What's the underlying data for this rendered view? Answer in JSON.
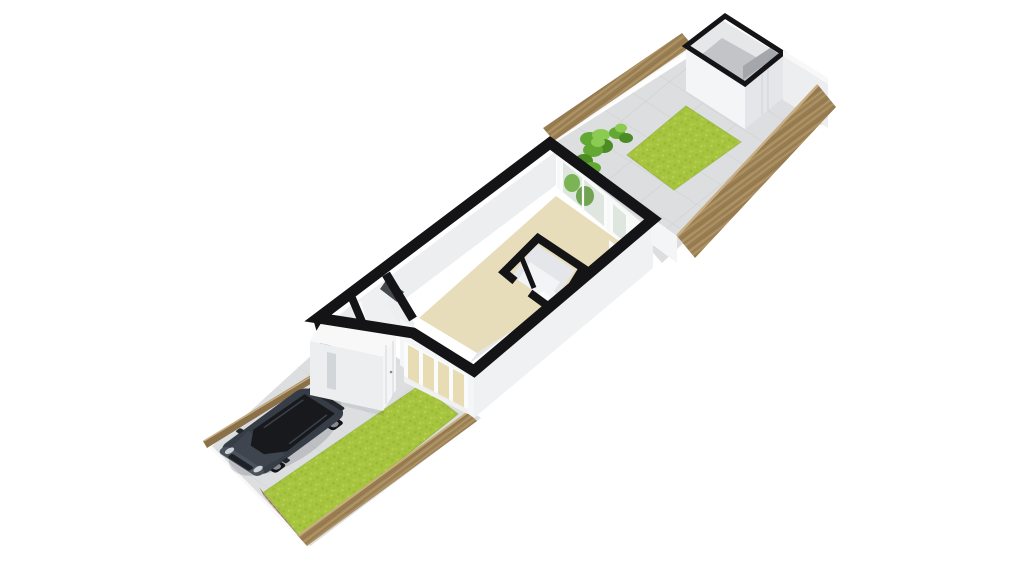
{
  "canvas": {
    "width": 1024,
    "height": 576,
    "background": "#ffffff"
  },
  "colors": {
    "background": "#ffffff",
    "wall_black": "#141417",
    "wall_white": "#f4f5f6",
    "wall_light": "#eceef0",
    "wall_shaded": "#e4e6e9",
    "wall_ext": "#eff1f3",
    "wall_bright": "#f8f8f9",
    "floor_beige": "#e8ddba",
    "floor_hall": "#e7e9eb",
    "floor_hall2": "#eef0f1",
    "floor_wc": "#f3f4f5",
    "alcove_dark": "#45484d",
    "paving": "#dcdee0",
    "paving_line": "#cbcdd1",
    "shadow": "rgba(30,33,38,0.16)",
    "shadow_soft": "rgba(30,33,38,0.08)",
    "grass": "#a7c43f",
    "grass_dark": "#85a82c",
    "grass_light": "#c6da69",
    "grass_edge": "#90ab33",
    "wood": "#a2875a",
    "wood_dark": "#82683f",
    "wood_light": "#c8ae82",
    "wood_dark_face": "#8b7149",
    "foliage": "#62a832",
    "foliage_dark": "#4c8c24",
    "foliage_light": "#8ccb52",
    "glass": "#dfe6e0",
    "glass_beige": "#e7dcb4",
    "glass_low": "#edefed",
    "window_frame": "#fafbfb",
    "seam": "#d3d6d9",
    "shed_inner": "#e6e7e9",
    "shed_floor": "#c2c4c8",
    "shed_shade": "#a3a6ab",
    "car_body": "#373d46",
    "car_body_dark": "#24282e",
    "car_hood": "#3e454f",
    "car_glass": "#17191d",
    "car_trim": "#4b525c",
    "car_light": "#ccd2d8",
    "car_wheel": "#121417",
    "car_rim": "#868a90",
    "car_grille": "#1d2025"
  },
  "scene": {
    "type": "3d-floor-plan-render",
    "projection": "isometric, plot runs bottom-left to top-right",
    "areas": [
      {
        "id": "front-garden",
        "features": [
          "paved driveway",
          "dark SUV parked",
          "lawn strip",
          "timber boundary fence"
        ]
      },
      {
        "id": "house",
        "rooms": [
          "open living room with beige floor",
          "hallway with angled wall and dark alcove",
          "inner WC with toilet",
          "entrance porch with front door"
        ],
        "features": [
          "glazed front wall",
          "rear window overlooking shrubs",
          "interior doors"
        ]
      },
      {
        "id": "rear-garden",
        "features": [
          "paved patio with tile joints",
          "lawn patch",
          "three shrubs",
          "timber fences both sides",
          "white end wall with gate"
        ]
      },
      {
        "id": "shed",
        "features": [
          "open-top storage shed",
          "black wall rim",
          "double door seams"
        ]
      }
    ],
    "counts": {
      "front_glazing_panes": 4,
      "rear_shrubs": 3,
      "visible_car_wheels": 2,
      "shed_door_seams": 2
    }
  }
}
